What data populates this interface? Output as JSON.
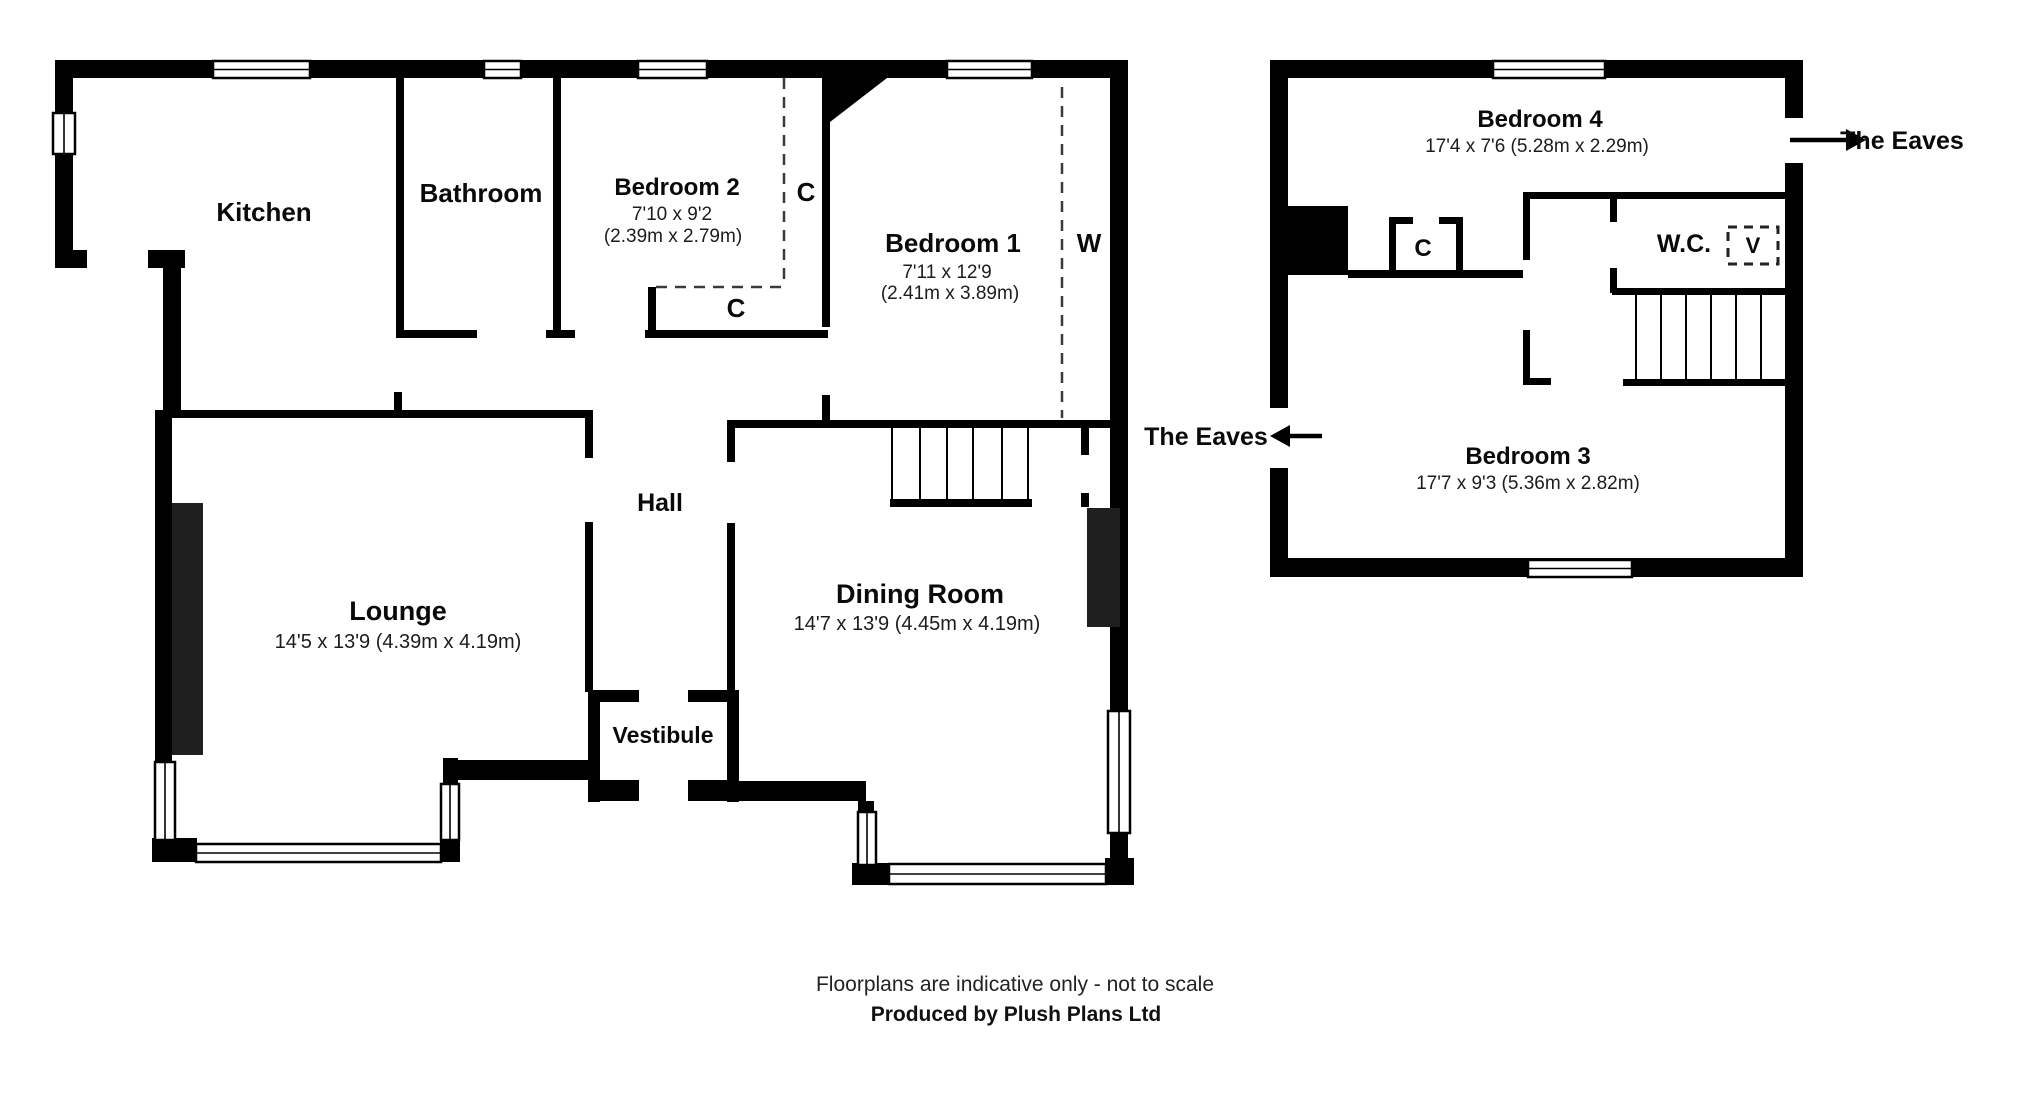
{
  "ground_floor": {
    "rooms": [
      {
        "name": "Kitchen"
      },
      {
        "name": "Bathroom"
      },
      {
        "name": "Bedroom 2",
        "dims_imperial": "7'10 x 9'2",
        "dims_metric": "(2.39m x 2.79m)"
      },
      {
        "name": "Bedroom 1",
        "dims_imperial": "7'11 x 12'9",
        "dims_metric": "(2.41m x 3.89m)"
      },
      {
        "name": "Hall"
      },
      {
        "name": "Lounge",
        "dims": "14'5 x 13'9 (4.39m x 4.19m)"
      },
      {
        "name": "Dining Room",
        "dims": "14'7 x 13'9 (4.45m x 4.19m)"
      },
      {
        "name": "Vestibule"
      }
    ],
    "closet_label_1": "C",
    "closet_label_2": "C",
    "wardrobe_label": "W"
  },
  "first_floor": {
    "rooms": [
      {
        "name": "Bedroom 4",
        "dims": "17'4 x 7'6 (5.28m x 2.29m)"
      },
      {
        "name": "W.C."
      },
      {
        "name": "Bedroom 3",
        "dims": "17'7 x 9'3 (5.36m x 2.82m)"
      }
    ],
    "closet_label": "C",
    "velux_label": "V",
    "eaves_label_left": "The Eaves",
    "eaves_label_right": "The Eaves"
  },
  "footer": {
    "line1": "Floorplans are indicative only - not to scale",
    "line2": "Produced by Plush Plans Ltd"
  }
}
